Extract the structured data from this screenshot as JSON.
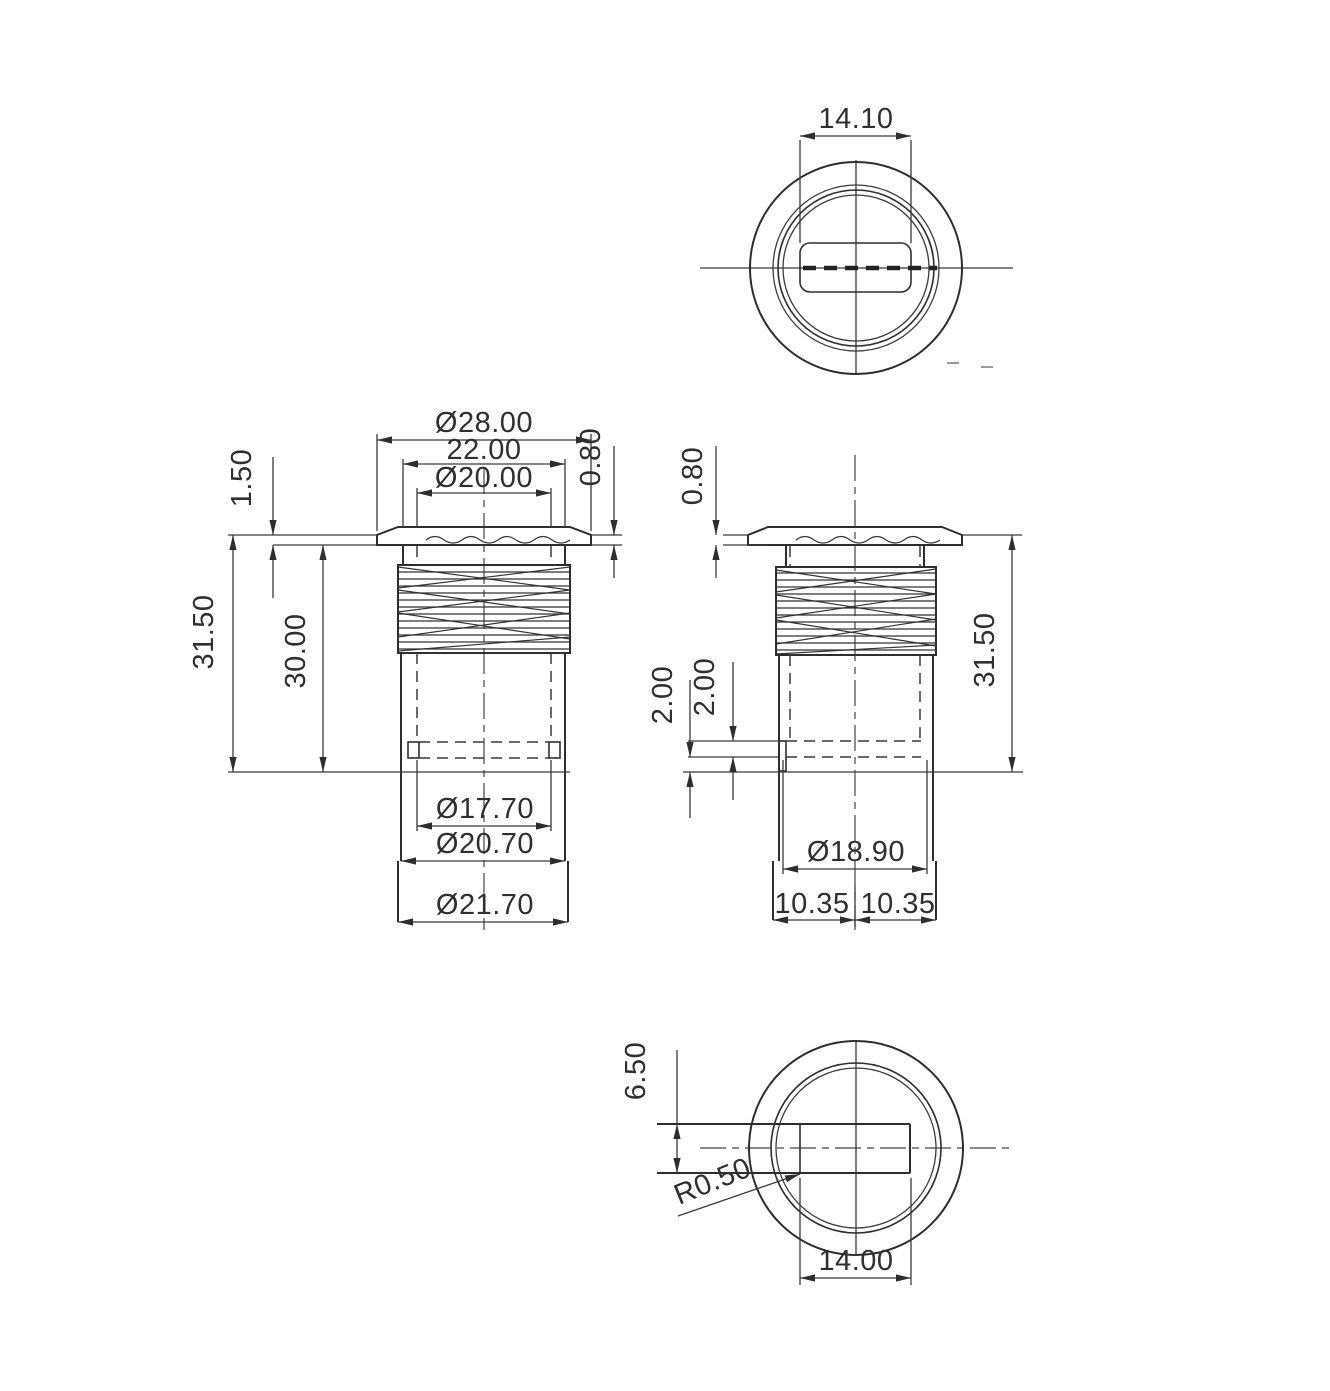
{
  "meta": {
    "drawing_type": "mechanical part orthographic views",
    "part": "flanged threaded bushing with slotted base"
  },
  "style": {
    "line_color": "#2e2e2e",
    "background": "#ffffff"
  },
  "top": {
    "slot_width": "14.10"
  },
  "front": {
    "flange_od": "Ø28.00",
    "flat_top_width": "22.00",
    "top_bore_dia": "Ø20.00",
    "flange_thickness": "1.50",
    "flange_rim_thickness": "0.80",
    "overall_height": "31.50",
    "height_below_flange": "30.00",
    "inner_bore_dia": "Ø17.70",
    "body_dia": "Ø20.70",
    "base_dia": "Ø21.70"
  },
  "side": {
    "flange_rim_thickness": "0.80",
    "overall_height": "31.50",
    "slot_clearance": "2.00",
    "slot_height": "2.00",
    "bore_dia": "Ø18.90",
    "half_width_left": "10.35",
    "half_width_right": "10.35"
  },
  "bottom": {
    "slot_height": "6.50",
    "corner_radius": "R0.50",
    "slot_width": "14.00"
  }
}
